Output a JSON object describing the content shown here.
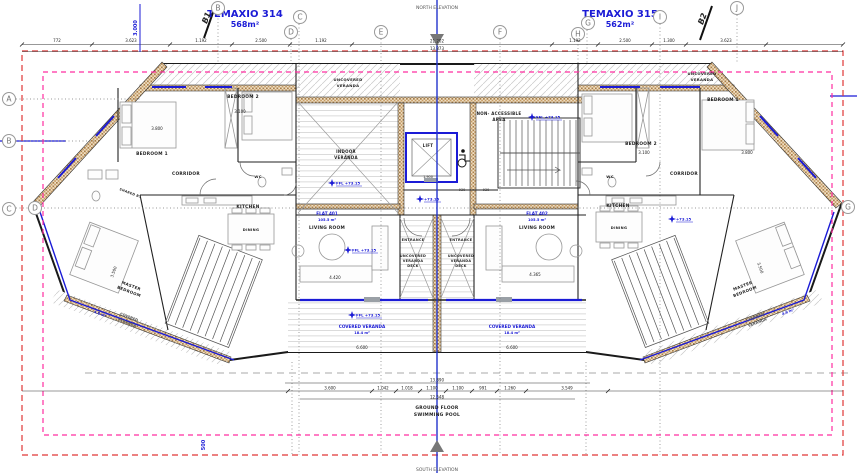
{
  "header": {
    "unit_left_name": "TEMAXIO 314",
    "unit_left_area": "568m²",
    "unit_right_name": "TEMAXIO 315",
    "unit_right_area": "562m²",
    "north": "NORTH ELEVATION",
    "south": "SOUTH ELEVATION",
    "section_b1": "B1",
    "section_b2": "B2"
  },
  "grid": {
    "a": "A",
    "b_left": "B",
    "c_left": "C",
    "d_left": "D",
    "b_top": "B",
    "c_top": "C",
    "d_top": "D",
    "e": "E",
    "f": "F",
    "g_top": "G",
    "h": "H",
    "i": "I",
    "j": "J",
    "g_right": "G"
  },
  "rooms": {
    "bedroom1": "BEDROOM 1",
    "bedroom2": "BEDROOM 2",
    "corridor": "CORRIDOR",
    "wc": "WC",
    "kitchen": "KITCHEN",
    "dining": "DINING",
    "flat_left_name": "FLAT 401",
    "flat_left_area": "105.5 m²",
    "flat_right_name": "FLAT 402",
    "flat_right_area": "105.5 m²",
    "living": "LIVING ROOM",
    "master_l1": "MASTER",
    "master_l2": "BEDROOM",
    "shared_bath": "SHARED B.",
    "lift": "LIFT",
    "non_accessible_l1": "NON- ACCESSIBLE",
    "non_accessible_l2": "AREA",
    "entrance": "ENTRANCE",
    "deck_l1": "UNCOVERED",
    "deck_l2": "VERANDA",
    "deck_l3": "DECK",
    "indoor_l1": "INDOOR",
    "indoor_l2": "VERANDA",
    "uncovered_l1": "UNCOVERED",
    "uncovered_l2": "VERANDA",
    "covered_main": "COVERED VERANDA",
    "covered_main_area": "18.4 m²",
    "covered_wing_l1": "COVERED",
    "covered_wing_l2": "VERANDA",
    "covered_wing_area": "4.6 m²",
    "pool_l1": "GROUND FLOOR",
    "pool_l2": "SWIMMING POOL"
  },
  "levels": {
    "ffl": "FFL +73.15",
    "lvl": "+73.15"
  },
  "dims": {
    "v3000": "3.000",
    "v772": "772",
    "v3623": "3.623",
    "v1192": "1.192",
    "v2500": "2.500",
    "v1300": "1.300",
    "v21202": "21.202",
    "v13873": "13.873",
    "v3800": "3.800",
    "v3100": "3.100",
    "v4420": "4.420",
    "v4365": "4.365",
    "v1900": "1.900",
    "v930": "930",
    "v3500": "3.500",
    "v6600": "6.600",
    "v13890": "13.890",
    "v12548": "12.548",
    "v3600": "3.600",
    "v1042": "1.042",
    "v1018": "1.018",
    "v1100": "1.100",
    "v991": "991",
    "v1260": "1.260",
    "v3549": "3.549",
    "v500": "500"
  },
  "colors": {
    "accent_blue": "#1b1bd6",
    "boundary_red": "#e03636",
    "boundary_pink": "#ff2da0",
    "wall_hatch_brown": "#a97e48"
  }
}
